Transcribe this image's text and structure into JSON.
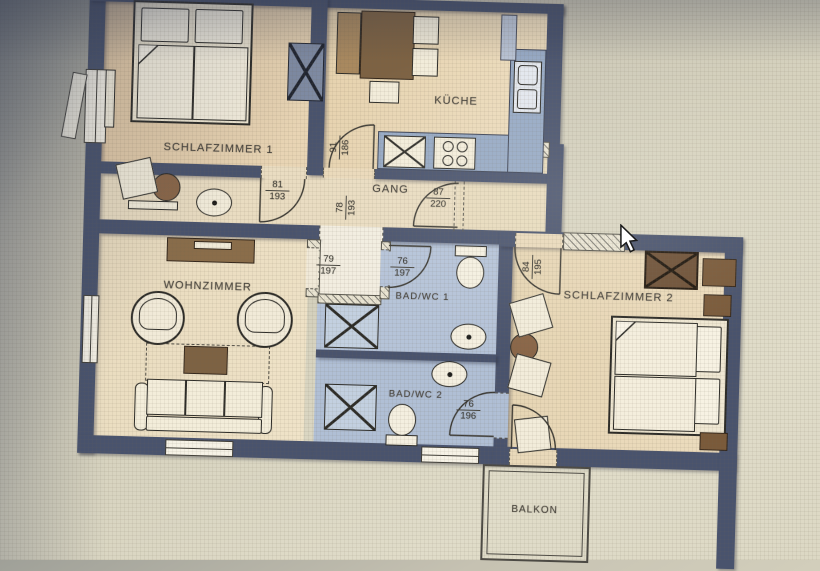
{
  "rooms": {
    "schlafzimmer1": {
      "label": "SCHLAFZIMMER 1"
    },
    "kueche": {
      "label": "KÜCHE"
    },
    "gang": {
      "label": "GANG"
    },
    "wohnzimmer": {
      "label": "WOHNZIMMER"
    },
    "badwc1": {
      "label": "BAD/WC 1"
    },
    "badwc2": {
      "label": "BAD/WC 2"
    },
    "schlafzimmer2": {
      "label": "SCHLAFZIMMER 2"
    },
    "balkon": {
      "label": "BALKON"
    }
  },
  "doors": {
    "schlafzimmer1": {
      "width": "81",
      "height": "193"
    },
    "kueche": {
      "width": "91",
      "height": "186"
    },
    "entry": {
      "width": "87",
      "height": "220"
    },
    "gang_lower": {
      "width": "78",
      "height": "193"
    },
    "wohnzimmer": {
      "width": "79",
      "height": "197"
    },
    "badwc1": {
      "width": "76",
      "height": "197"
    },
    "schlafzimmer2": {
      "width": "84",
      "height": "195"
    },
    "badwc2": {
      "width": "76",
      "height": "196"
    }
  },
  "colors": {
    "wall": "#49536d",
    "room_floor": "#e9d9bb",
    "bath_floor": "#b3c2d8",
    "kitchen_counter": "#96a9c4",
    "furniture_brown": "#7d6243",
    "paper": "#d9d5c2"
  }
}
